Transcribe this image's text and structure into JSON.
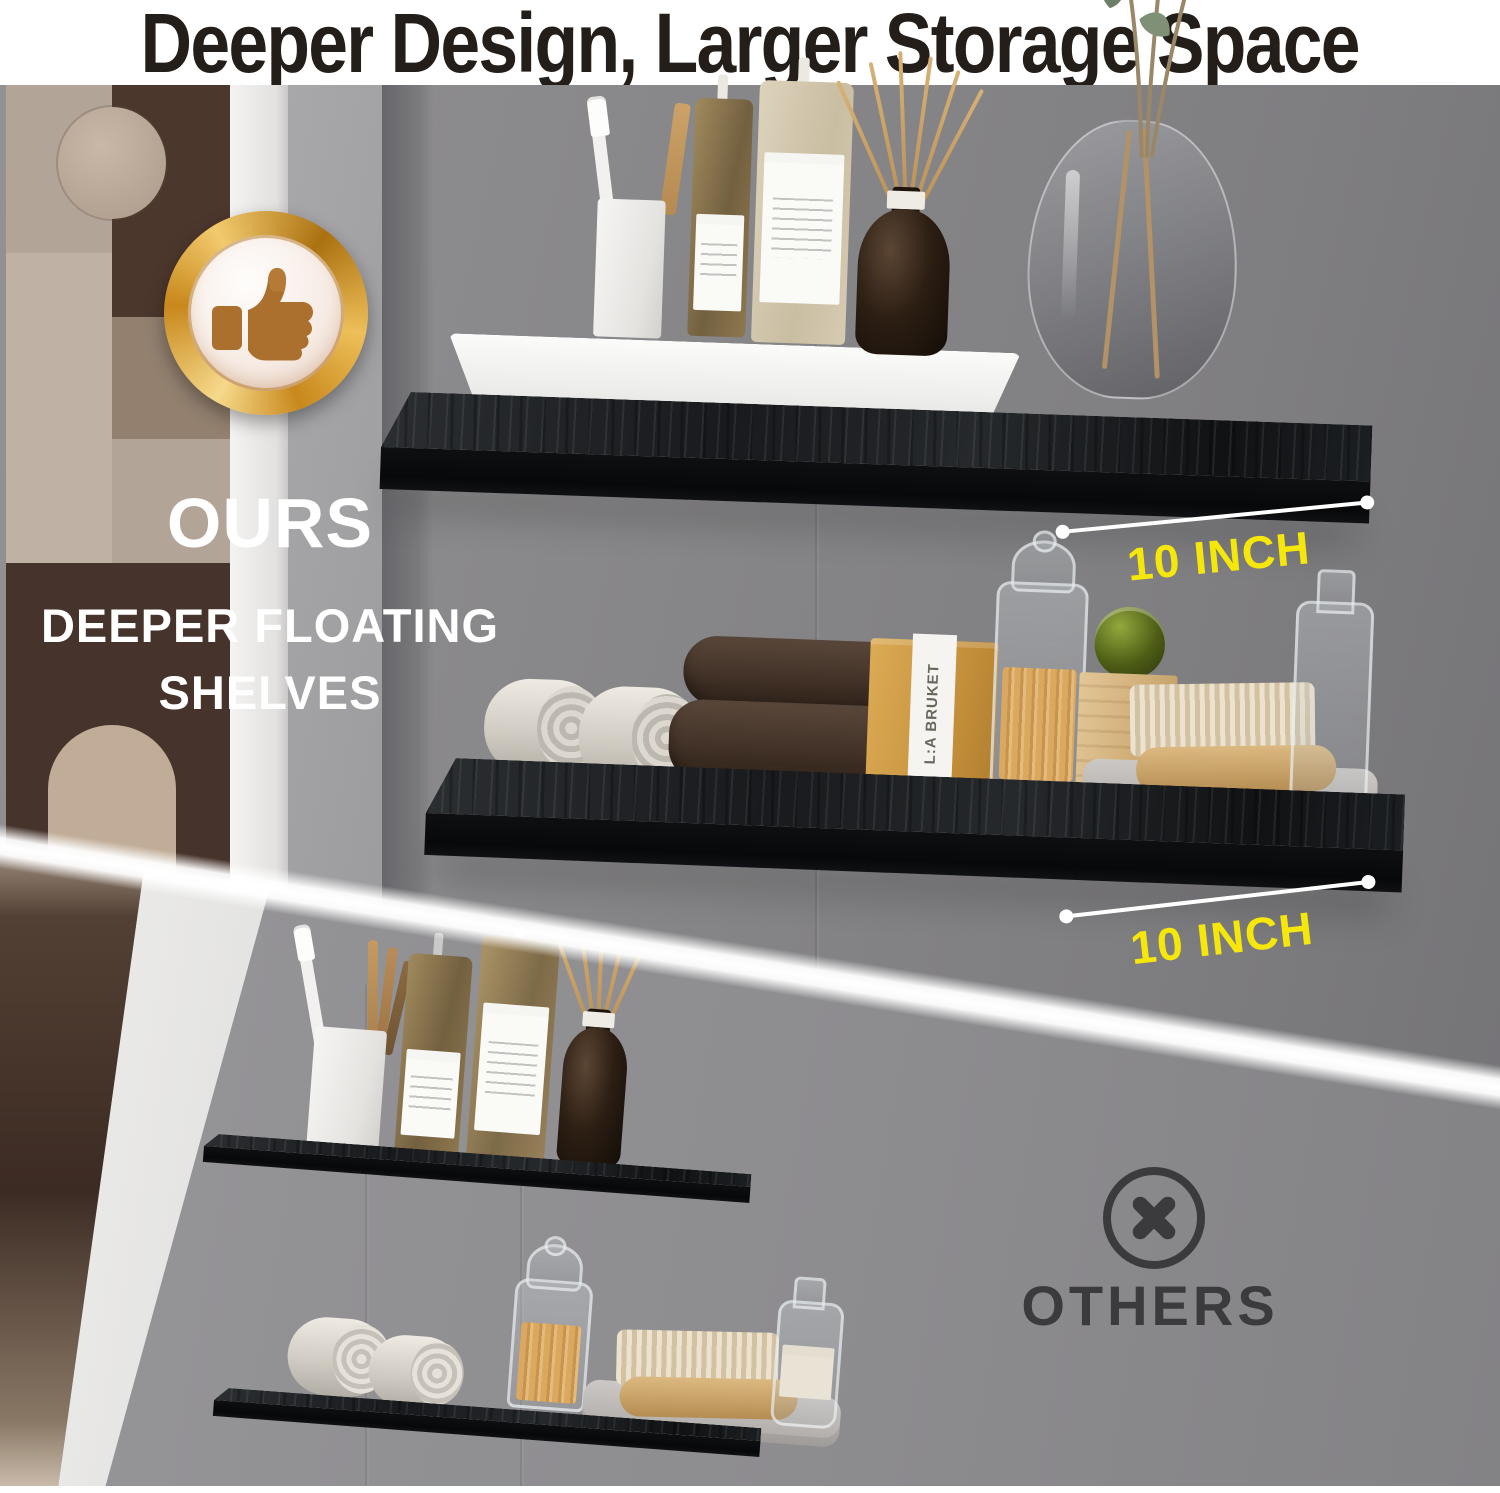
{
  "header": {
    "title": "Deeper Design, Larger Storage Space"
  },
  "ours": {
    "badge_icon": "thumbs-up-icon",
    "label": "OURS",
    "subtitle_line1": "DEEPER FLOATING",
    "subtitle_line2": "SHELVES",
    "depth_labels": [
      "10 INCH",
      "10 INCH"
    ]
  },
  "others": {
    "icon": "circle-x-icon",
    "label": "OTHERS"
  },
  "products": {
    "soap_box_brand": "L:A BRUKET"
  },
  "colors": {
    "accent_yellow": "#F6E70B",
    "badge_gold": "#D89B2D",
    "badge_thumb_brown": "#AB6F2E",
    "wall_gray_top": "#868587",
    "wall_gray_bottom": "#8F8E91",
    "shelf_black": "#121417",
    "title_text": "#231E19",
    "others_text": "#3B3A3C",
    "white": "#FFFFFF"
  }
}
